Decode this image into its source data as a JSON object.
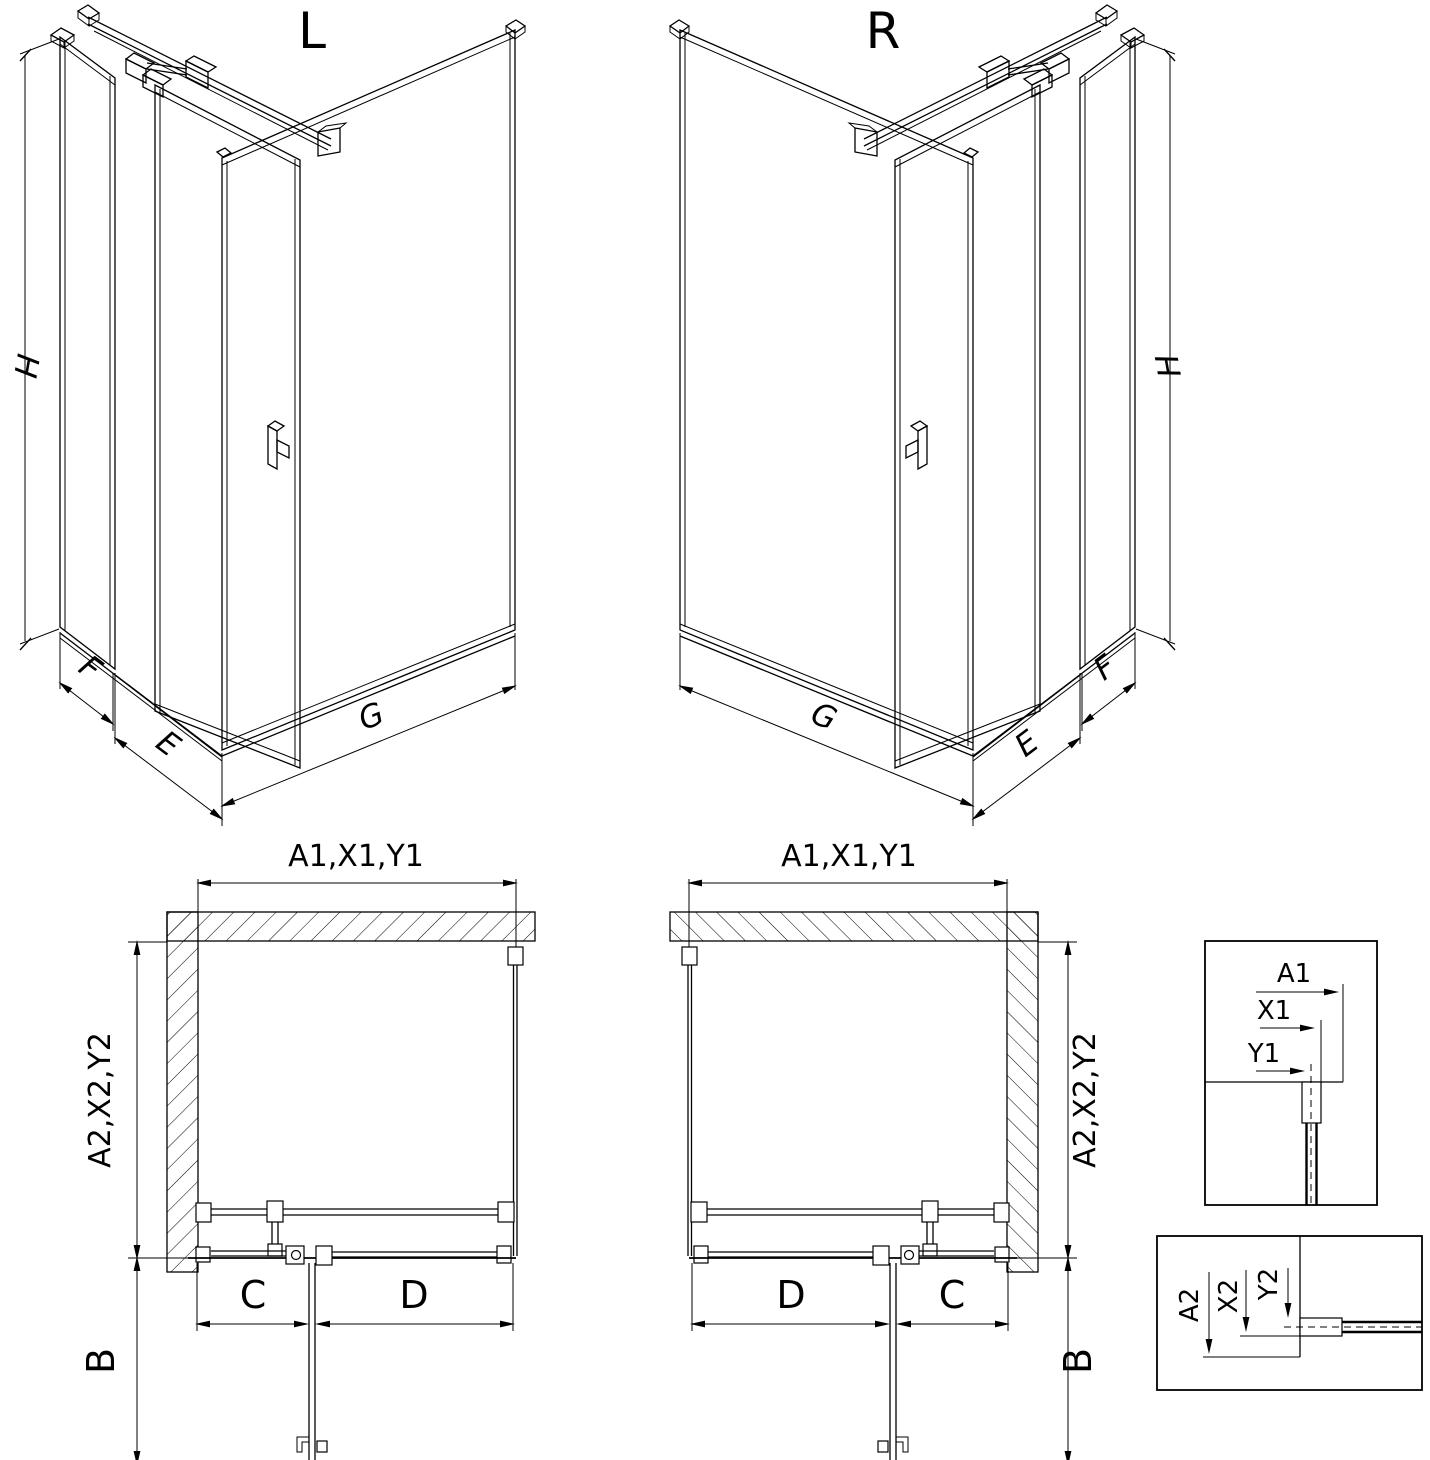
{
  "page": {
    "background": "#ffffff",
    "line_color": "#000000"
  },
  "iso_left": {
    "label": "L",
    "dim_height": "H",
    "dim_side_panel": "F",
    "dim_door": "E",
    "dim_fixed_panel": "G"
  },
  "iso_right": {
    "label": "R",
    "dim_height": "H",
    "dim_side_panel": "F",
    "dim_door": "E",
    "dim_fixed_panel": "G"
  },
  "plan_left": {
    "dim_top": "A1,X1,Y1",
    "dim_side": "A2,X2,Y2",
    "dim_door_width": "C",
    "dim_fixed_width": "D",
    "dim_door_swing": "B"
  },
  "plan_right": {
    "dim_top": "A1,X1,Y1",
    "dim_side": "A2,X2,Y2",
    "dim_door_width": "C",
    "dim_fixed_width": "D",
    "dim_door_swing": "B"
  },
  "detail_horizontal": {
    "dim_outer": "A1",
    "dim_mid": "X1",
    "dim_inner": "Y1"
  },
  "detail_vertical": {
    "dim_outer": "A2",
    "dim_mid": "X2",
    "dim_inner": "Y2"
  }
}
